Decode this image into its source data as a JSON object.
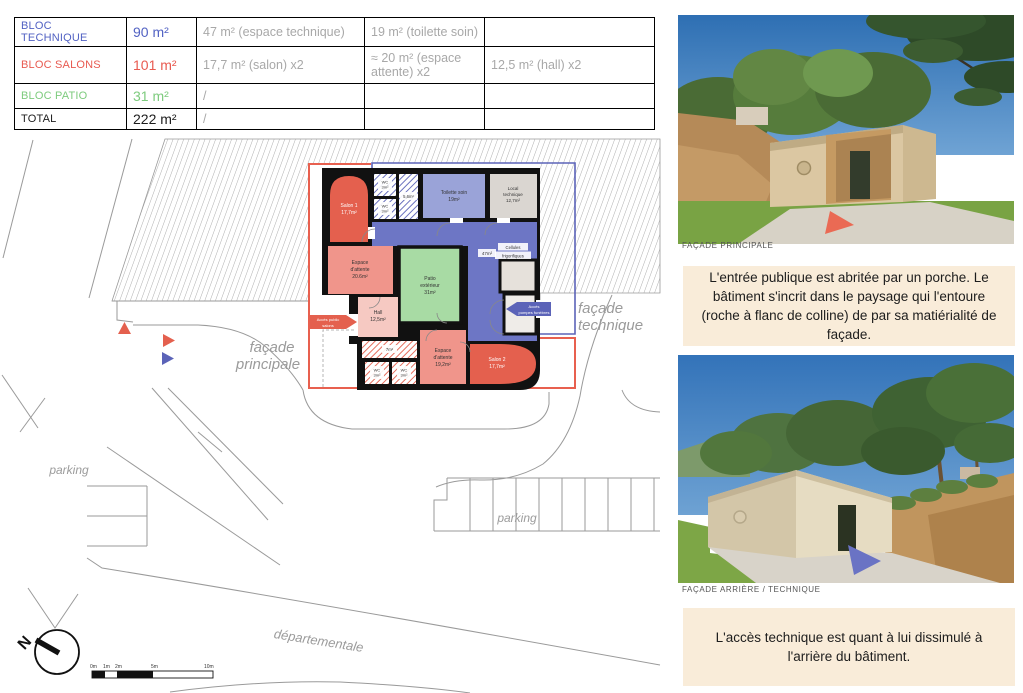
{
  "table": {
    "rows": [
      {
        "label": "BLOC TECHNIQUE",
        "value": "90 m²",
        "c3": "47 m² (espace technique)",
        "c4": "19 m² (toilette soin)",
        "c5": "",
        "color": "#5262c3"
      },
      {
        "label": "BLOC SALONS",
        "value": "101 m²",
        "c3": "17,7 m² (salon) x2",
        "c4": "≈ 20 m² (espace attente) x2",
        "c5": "12,5 m² (hall) x2",
        "color": "#e85a50"
      },
      {
        "label": "BLOC PATIO",
        "value": "31 m²",
        "c3": "/",
        "c4": "",
        "c5": "",
        "color": "#7dcb7d"
      },
      {
        "label": "TOTAL",
        "value": "222 m²",
        "c3": "/",
        "c4": "",
        "c5": "",
        "color": "#1c1c1c"
      }
    ]
  },
  "plan": {
    "rooms": {
      "salon1": {
        "lines": [
          "Salon 1",
          "17,7m²"
        ]
      },
      "wc_top1": {
        "lines": [
          "WC",
          "3m²"
        ]
      },
      "wc_top2": {
        "lines": [
          "WC",
          "3m²"
        ]
      },
      "r56": {
        "lines": [
          "5,6m²"
        ]
      },
      "toilette": {
        "lines": [
          "Toilette soin",
          "19m²"
        ]
      },
      "local": {
        "lines": [
          "Local",
          "technique",
          "12,7m²"
        ]
      },
      "corridor": {
        "lines": [
          "47m²"
        ]
      },
      "cellules": {
        "lines": [
          "Cellules",
          "frigorifiques"
        ]
      },
      "espace1": {
        "lines": [
          "Espace",
          "d'attente",
          "20.6m²"
        ]
      },
      "patio": {
        "lines": [
          "Patio",
          "extérieur",
          "31m²"
        ]
      },
      "hall": {
        "lines": [
          "Hall",
          "12,5m²"
        ]
      },
      "espace2": {
        "lines": [
          "Espace",
          "d'attente",
          "19,2m²"
        ]
      },
      "salon2": {
        "lines": [
          "Salon 2",
          "17,7m²"
        ]
      },
      "r7": {
        "lines": [
          "7m²"
        ]
      },
      "wc_bot1": {
        "lines": [
          "WC",
          "3m²"
        ]
      },
      "wc_bot2": {
        "lines": [
          "WC",
          "3m²"
        ]
      }
    },
    "access": {
      "public": {
        "lines": [
          "Accès public",
          "salons"
        ]
      },
      "pompes": {
        "lines": [
          "Accès",
          "pompes funèbres"
        ]
      }
    },
    "facades": {
      "principale": {
        "lines": [
          "façade",
          "principale"
        ]
      },
      "technique": {
        "lines": [
          "façade",
          "technique"
        ]
      }
    },
    "site": {
      "parking_left": "parking",
      "parking_center": "parking",
      "road": "départementale"
    },
    "compass": {
      "n": "N"
    },
    "scale": {
      "labels": [
        "0m",
        "1m",
        "2m",
        "5m",
        "10m"
      ]
    }
  },
  "right": {
    "photo1_caption": "FAÇADE PRINCIPALE",
    "photo2_caption": "FAÇADE ARRIÈRE / TECHNIQUE",
    "note1": "L'entrée publique est abritée par un porche. Le bâtiment s'incrit dans le paysage qui l'entoure (roche à flanc de colline) de par sa matiérialité de façade.",
    "note2": "L'accès technique est quant à lui dissimulé à l'arrière du bâtiment."
  },
  "colors": {
    "bloc_technique_accent": "#5262c3",
    "bloc_salons_accent": "#e85a50",
    "bloc_patio_accent": "#7dcb7d",
    "corridor_fill": "#6d76c5",
    "toilette_fill": "#9aa3d8",
    "patio_fill": "#a8dba4",
    "salon_fill": "#e4604e",
    "attente_fill": "#f0958b",
    "hall_fill": "#f6c9c2",
    "local_fill": "#dad6d1",
    "note_background": "#f9ecd9",
    "detail_gray": "#a8a8a8"
  }
}
